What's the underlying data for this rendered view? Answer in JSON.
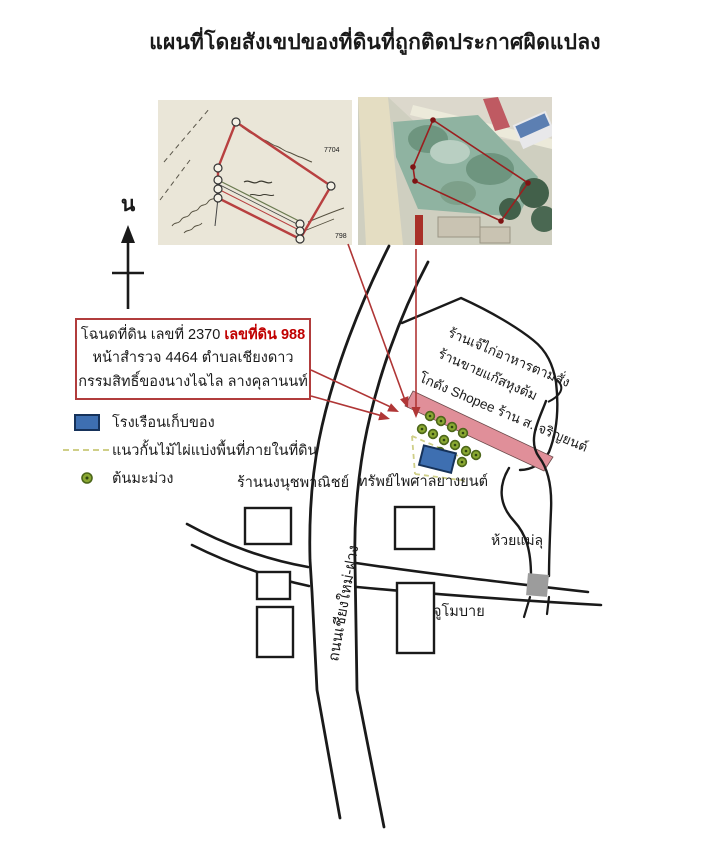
{
  "title": "แผนที่โดยสังเขปของที่ดินที่ถูกติดประกาศผิดแปลง",
  "north_label": "น",
  "deed_box": {
    "line1_black": "โฉนดที่ดิน เลขที่ 2370",
    "line1_red": "เลขที่ดิน 988",
    "line2": "หน้าสำรวจ 4464 ตำบลเชียงดาว",
    "line3": "กรรมสิทธิ์ของนางไฉไล ลางคุลานนท์"
  },
  "legend": {
    "items": [
      {
        "symbol": "blue-building-swatch",
        "label": "โรงเรือนเก็บของ"
      },
      {
        "symbol": "dashed-line-swatch",
        "label": "แนวกั้นไม้ไผ่แบ่งพื้นที่ภายในที่ดิน"
      },
      {
        "symbol": "tree-dot-swatch",
        "label": "ต้นมะม่วง"
      }
    ]
  },
  "map_labels": {
    "shop1": "ร้านเจ๊ไก่อาหารตามสั่ง",
    "shop2": "ร้านขายแก๊สหุงต้ม",
    "shop3": "โกดัง Shopee  ร้าน ส.เจริญยนต์",
    "shop_left": "ร้านนงนุชพาณิชย์",
    "tire_shop": "ทรัพย์ไพศาลยางยนต์",
    "garage": "จูโมบาย",
    "stream": "ห้วยแม่ลุ",
    "road": "ถนนเชียงใหม่-ฝาง"
  },
  "insets": {
    "cadastral_number_1": "7704",
    "cadastral_number_2": "798"
  },
  "colors": {
    "highlight_red": "#b13c3c",
    "deed_red_text": "#c00000",
    "building_blue": "#3e6fb1",
    "bamboo_dash": "#cfcf88",
    "tree_green": "#8aa832",
    "strip_pink": "#e08f99",
    "culvert_gray": "#9c9c9c"
  }
}
